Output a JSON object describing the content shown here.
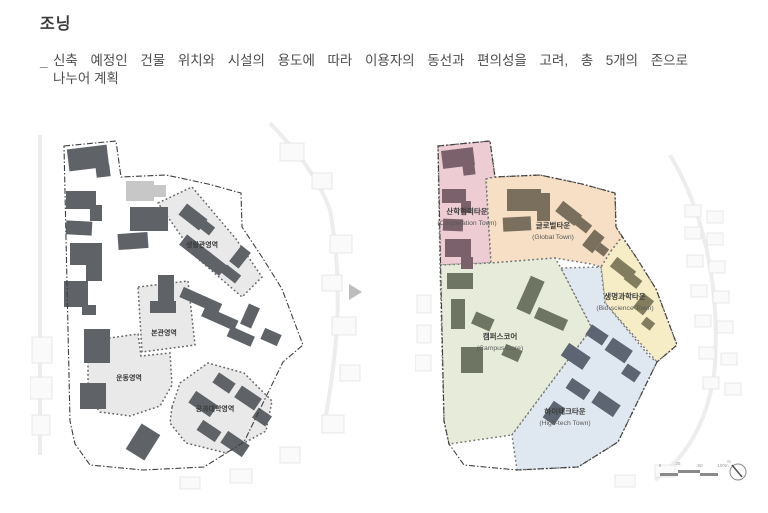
{
  "page": {
    "title": "조닝"
  },
  "intro": {
    "marker": "_",
    "line1": "신축 예정인 건물 위치와 시설의 용도에 따라 이용자의 동선과 편의성을 고려, 총 5개의 존으로",
    "line2": "나누어 계획"
  },
  "left_map": {
    "zone_fill": "#e9e9e9",
    "building_color": "#5f6368",
    "boundary_color": "#3f3f3f",
    "areas": [
      {
        "label": "생활관영역"
      },
      {
        "label": "본관영역"
      },
      {
        "label": "운동영역"
      },
      {
        "label": "공과대학영역"
      }
    ]
  },
  "right_map": {
    "boundary_color": "#3f3f3f",
    "zones": [
      {
        "kr": "산학협력타운",
        "en": "(Cooperation Town)",
        "color": "#edccd3",
        "building_color": "#7b616b"
      },
      {
        "kr": "글로벌타운",
        "en": "(Global Town)",
        "color": "#f6dfc5",
        "building_color": "#7a6e5d"
      },
      {
        "kr": "생명과학타운",
        "en": "(Bio-science Town)",
        "color": "#f6edc6",
        "building_color": "#837d5f"
      },
      {
        "kr": "캠퍼스코어",
        "en": "(Campus Core)",
        "color": "#e6ecd9",
        "building_color": "#6e7562"
      },
      {
        "kr": "하이테크타운",
        "en": "(High-tech Town)",
        "color": "#dfe8f1",
        "building_color": "#5c6571"
      }
    ],
    "scale": {
      "ticks": [
        "0",
        "25",
        "50",
        "100m"
      ]
    },
    "north": "N"
  }
}
